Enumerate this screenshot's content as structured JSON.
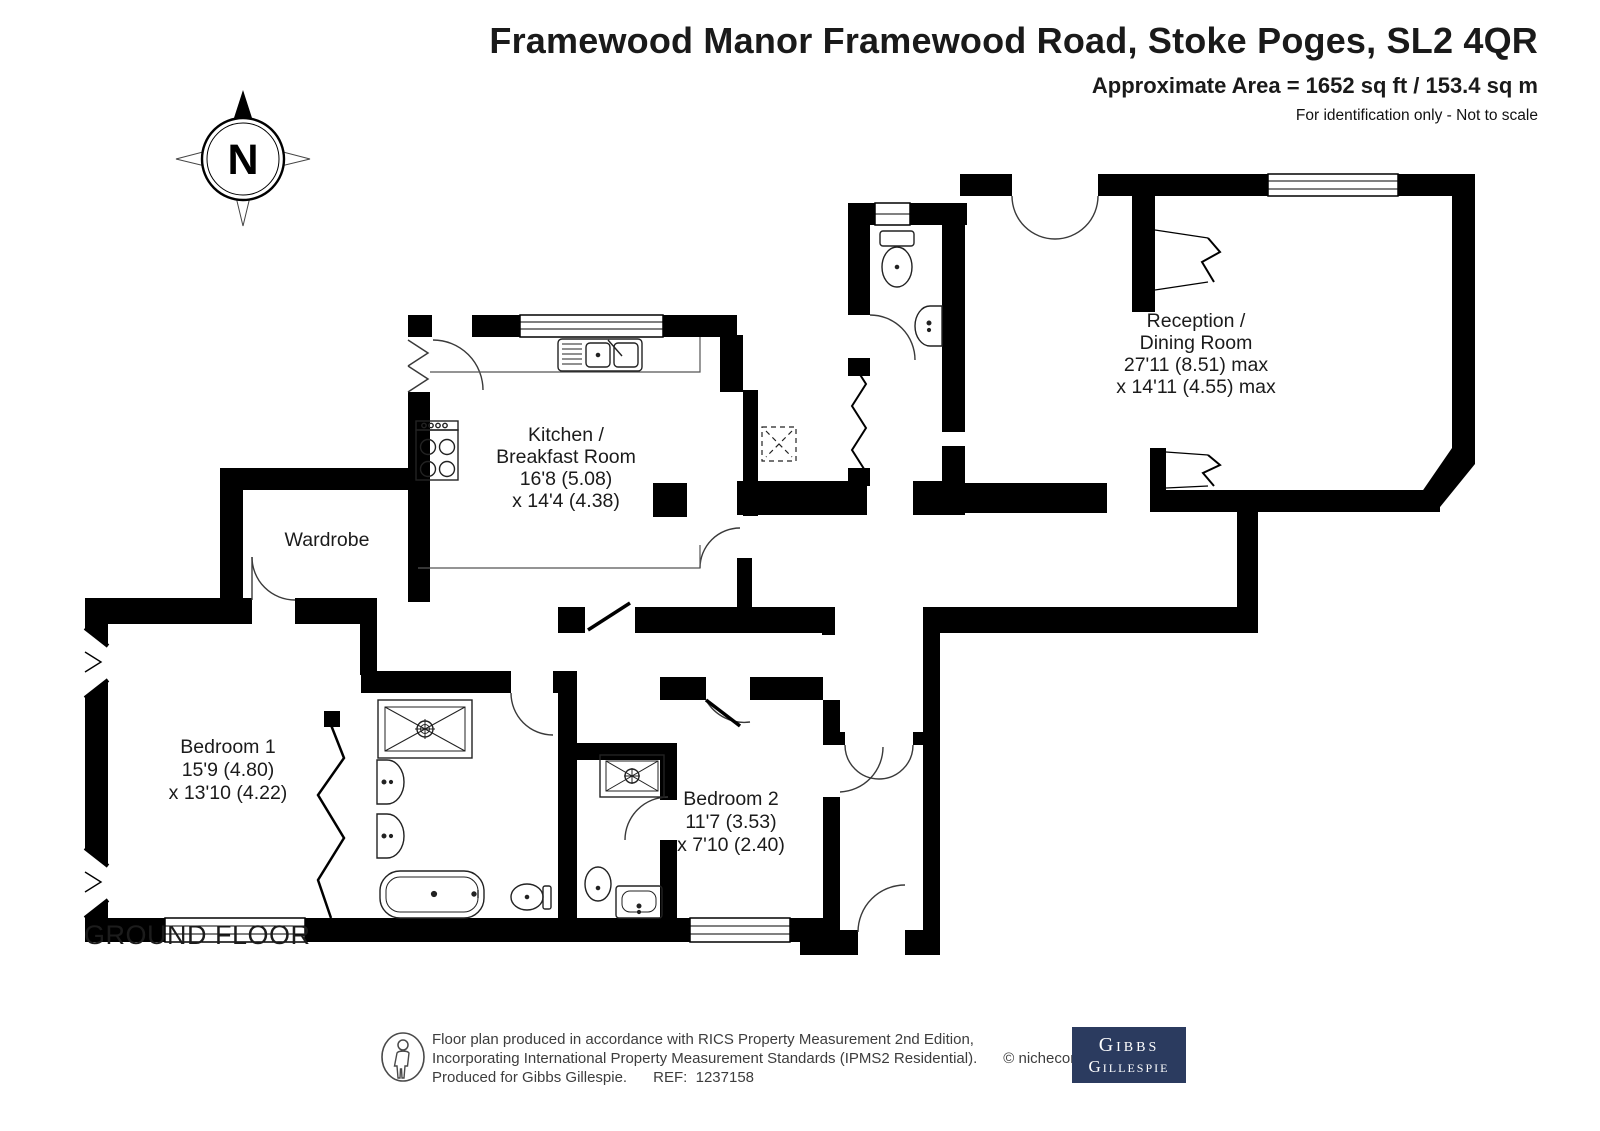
{
  "header": {
    "title": "Framewood Manor Framewood Road, Stoke Poges, SL2 4QR",
    "area": "Approximate Area = 1652 sq ft / 153.4 sq m",
    "note": "For identification only - Not to scale"
  },
  "compass": {
    "label": "N"
  },
  "floor_label": "GROUND FLOOR",
  "rooms": {
    "reception": {
      "line1": "Reception /",
      "line2": "Dining Room",
      "line3": "27'11 (8.51) max",
      "line4": "x 14'11 (4.55) max"
    },
    "kitchen": {
      "line1": "Kitchen /",
      "line2": "Breakfast Room",
      "line3": "16'8 (5.08)",
      "line4": "x 14'4 (4.38)"
    },
    "wardrobe": {
      "line1": "Wardrobe"
    },
    "bedroom1": {
      "line1": "Bedroom 1",
      "line2": "15'9 (4.80)",
      "line3": "x 13'10 (4.22)"
    },
    "bedroom2": {
      "line1": "Bedroom 2",
      "line2": "11'7 (3.53)",
      "line3": "x 7'10 (2.40)"
    }
  },
  "footer": {
    "line1": "Floor plan produced in accordance with RICS Property Measurement 2nd Edition,",
    "line2": "Incorporating International Property Measurement Standards (IPMS2 Residential).",
    "copyright": "© nichecom 2025.",
    "line3": "Produced for Gibbs Gillespie.",
    "ref": "REF:  1237158",
    "logo_line1": "Gibbs",
    "logo_line2": "Gillespie"
  },
  "colors": {
    "wall": "#000000",
    "logo_bg": "#2b3b5f",
    "text": "#1a1a1a"
  }
}
